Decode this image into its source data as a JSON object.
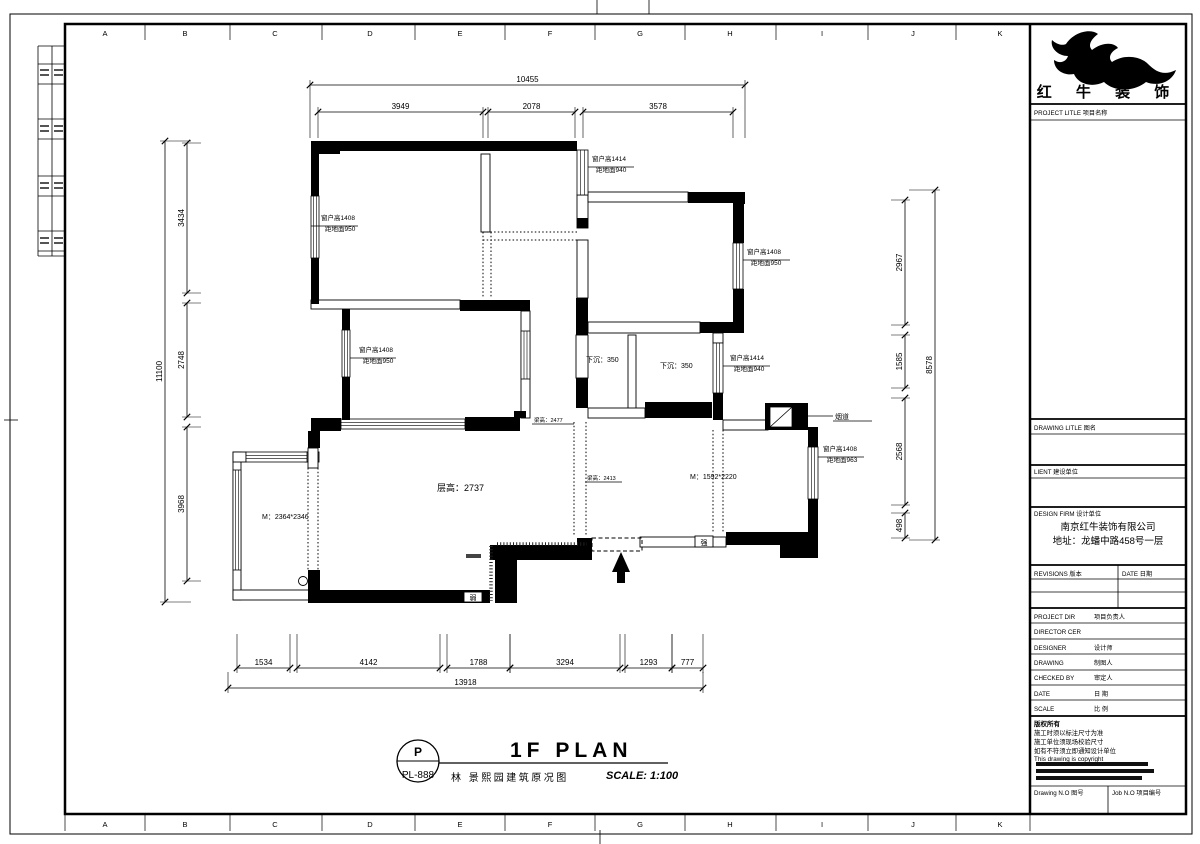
{
  "brand": {
    "company": "红 牛 装 饰",
    "project_label": "PROJECT LITLE  项目名称",
    "drawing_label": "DRAWING LITLE  图名",
    "client_label": "LIENT  建设单位",
    "design_firm_label": "DESIGN FIRM  设计单位",
    "firm_name": "南京红牛装饰有限公司",
    "firm_address": "地址：龙蟠中路458号一层",
    "revisions_label": "REVISIONS  版本",
    "date_col_label": "DATE  日期",
    "rows": [
      [
        "PROJECT DIR",
        "项目负责人"
      ],
      [
        "DIRECTOR CER",
        ""
      ],
      [
        "DESIGNER",
        "设计师"
      ],
      [
        "DRAWING",
        "制图人"
      ],
      [
        "CHECKED BY",
        "审定人"
      ],
      [
        "DATE",
        "日 期"
      ],
      [
        "SCALE",
        "比 例"
      ]
    ],
    "copyright_lines": [
      "版权所有",
      "施工时须以标注尺寸为准",
      "施工单位须现场校验尺寸",
      "如有不符须立即通知设计单位",
      "This drawing is copyright"
    ],
    "drawing_no_label": "Drawing N.O  图号",
    "job_no_label": "Job N.O  项目编号"
  },
  "title": {
    "code_top": "P",
    "code_bottom": "PL-888",
    "main": "1F PLAN",
    "sub": "林 景熙园建筑原况图",
    "scale": "SCALE: 1:100"
  },
  "grid_letters": [
    "A",
    "B",
    "C",
    "D",
    "E",
    "F",
    "G",
    "H",
    "I",
    "J",
    "K"
  ],
  "dims": [
    {
      "o": "h",
      "p": 85,
      "a": 310,
      "b": 745,
      "t": "10455",
      "e": 53
    },
    {
      "o": "h",
      "p": 112,
      "a": 318,
      "b": 483,
      "t": "3949",
      "e": 26
    },
    {
      "o": "h",
      "p": 112,
      "a": 488,
      "b": 575,
      "t": "2078",
      "e": 26
    },
    {
      "o": "h",
      "p": 112,
      "a": 583,
      "b": 733,
      "t": "3578",
      "e": 26
    },
    {
      "o": "v",
      "p": 165,
      "a": 141,
      "b": 602,
      "t": "11100",
      "e": 26
    },
    {
      "o": "v",
      "p": 187,
      "a": 143,
      "b": 293,
      "t": "3434",
      "e": 14
    },
    {
      "o": "v",
      "p": 187,
      "a": 303,
      "b": 417,
      "t": "2748",
      "e": 14
    },
    {
      "o": "v",
      "p": 187,
      "a": 427,
      "b": 581,
      "t": "3968",
      "e": 14
    },
    {
      "o": "v",
      "p": 935,
      "a": 190,
      "b": 540,
      "t": "8578",
      "e": -26
    },
    {
      "o": "v",
      "p": 905,
      "a": 200,
      "b": 325,
      "t": "2967",
      "e": -14
    },
    {
      "o": "v",
      "p": 905,
      "a": 335,
      "b": 388,
      "t": "1585",
      "e": -14
    },
    {
      "o": "v",
      "p": 905,
      "a": 398,
      "b": 505,
      "t": "2568",
      "e": -14
    },
    {
      "o": "v",
      "p": 905,
      "a": 513,
      "b": 538,
      "t": "498",
      "e": -14
    },
    {
      "o": "h",
      "p": 668,
      "a": 237,
      "b": 290,
      "t": "1534",
      "e": -34
    },
    {
      "o": "h",
      "p": 668,
      "a": 297,
      "b": 440,
      "t": "4142",
      "e": -34
    },
    {
      "o": "h",
      "p": 668,
      "a": 447,
      "b": 510,
      "t": "1788",
      "e": -34
    },
    {
      "o": "h",
      "p": 668,
      "a": 510,
      "b": 620,
      "t": "3294",
      "e": -34
    },
    {
      "o": "h",
      "p": 668,
      "a": 625,
      "b": 672,
      "t": "1293",
      "e": -34
    },
    {
      "o": "h",
      "p": 668,
      "a": 672,
      "b": 703,
      "t": "777",
      "e": -34
    },
    {
      "o": "h",
      "p": 688,
      "a": 228,
      "b": 703,
      "t": "13918",
      "e": -16
    }
  ],
  "annotations": [
    {
      "l1": "窗户高1408",
      "l2": "距地面950",
      "x": 321,
      "y": 220,
      "u": [
        311,
        226,
        358,
        226
      ]
    },
    {
      "l1": "窗户高1408",
      "l2": "距地面950",
      "x": 359,
      "y": 352,
      "u": [
        350,
        358,
        396,
        358
      ]
    },
    {
      "l1": "窗户高1414",
      "l2": "距地面940",
      "x": 592,
      "y": 161,
      "u": [
        588,
        167,
        634,
        167
      ]
    },
    {
      "l1": "窗户高1408",
      "l2": "距地面950",
      "x": 747,
      "y": 254,
      "u": [
        743,
        260,
        790,
        260
      ]
    },
    {
      "l1": "窗户高1414",
      "l2": "距地面940",
      "x": 730,
      "y": 360,
      "u": [
        723,
        366,
        770,
        366
      ]
    },
    {
      "l1": "窗户高1408",
      "l2": "距地面963",
      "x": 823,
      "y": 451,
      "u": [
        818,
        457,
        864,
        457
      ]
    }
  ],
  "labels": [
    {
      "t": "层高：2737",
      "x": 437,
      "y": 491,
      "fs": 9
    },
    {
      "t": "M：2364*2346",
      "x": 262,
      "y": 519,
      "fs": 7
    },
    {
      "t": "M：1592*2220",
      "x": 690,
      "y": 479,
      "fs": 7
    },
    {
      "t": "下沉：350",
      "x": 586,
      "y": 362,
      "fs": 7
    },
    {
      "t": "下沉：350",
      "x": 660,
      "y": 368,
      "fs": 7
    },
    {
      "t": "梁高：2477",
      "x": 534,
      "y": 422,
      "fs": 5.5,
      "ul": [
        532,
        424,
        574,
        424
      ]
    },
    {
      "t": "梁高：2413",
      "x": 587,
      "y": 480,
      "fs": 5.5,
      "ul": [
        585,
        482,
        622,
        482
      ]
    },
    {
      "t": "烟道",
      "x": 835,
      "y": 419,
      "fs": 7,
      "ul": [
        806,
        416,
        833,
        416
      ],
      "ul2": [
        833,
        421,
        872,
        421
      ]
    }
  ],
  "boxes": [
    {
      "t": "弱",
      "x": 464,
      "y": 592,
      "w": 18,
      "h": 10
    },
    {
      "t": "强",
      "x": 695,
      "y": 536,
      "w": 18,
      "h": 11
    }
  ],
  "plan": {
    "black_rects": [
      [
        311,
        141,
        29,
        13
      ],
      [
        340,
        141,
        237,
        10
      ],
      [
        688,
        192,
        55,
        11
      ],
      [
        733,
        192,
        12,
        12
      ],
      [
        311,
        154,
        8,
        42
      ],
      [
        311,
        258,
        8,
        46
      ],
      [
        342,
        309,
        8,
        21
      ],
      [
        342,
        377,
        8,
        43
      ],
      [
        460,
        300,
        70,
        11
      ],
      [
        465,
        417,
        55,
        14
      ],
      [
        514,
        411,
        12,
        7
      ],
      [
        311,
        418,
        30,
        13
      ],
      [
        577,
        218,
        11,
        10
      ],
      [
        733,
        203,
        11,
        40
      ],
      [
        733,
        289,
        11,
        44
      ],
      [
        700,
        322,
        43,
        11
      ],
      [
        576,
        298,
        12,
        37
      ],
      [
        576,
        378,
        12,
        30
      ],
      [
        645,
        402,
        67,
        16
      ],
      [
        713,
        393,
        10,
        27
      ],
      [
        765,
        403,
        43,
        27
      ],
      [
        808,
        427,
        10,
        20
      ],
      [
        808,
        499,
        10,
        46
      ],
      [
        726,
        532,
        92,
        13
      ],
      [
        780,
        532,
        38,
        26
      ],
      [
        308,
        431,
        12,
        17
      ],
      [
        308,
        570,
        12,
        33
      ],
      [
        318,
        590,
        172,
        13
      ],
      [
        490,
        545,
        97,
        15
      ],
      [
        495,
        560,
        22,
        43
      ],
      [
        577,
        538,
        15,
        22
      ]
    ],
    "thin_rects": [
      [
        481,
        154,
        9,
        78
      ],
      [
        577,
        195,
        11,
        33
      ],
      [
        588,
        192,
        100,
        10
      ],
      [
        588,
        322,
        112,
        11
      ],
      [
        577,
        240,
        11,
        58
      ],
      [
        576,
        335,
        12,
        43
      ],
      [
        628,
        335,
        8,
        75
      ],
      [
        713,
        333,
        10,
        10
      ],
      [
        311,
        300,
        149,
        9
      ],
      [
        521,
        311,
        9,
        107
      ],
      [
        233,
        452,
        8,
        148
      ],
      [
        233,
        590,
        78,
        10
      ],
      [
        233,
        452,
        13,
        10
      ],
      [
        305,
        452,
        14,
        10
      ],
      [
        723,
        420,
        45,
        10
      ],
      [
        308,
        448,
        10,
        20
      ],
      [
        588,
        408,
        57,
        10
      ],
      [
        640,
        537,
        86,
        10
      ]
    ],
    "windows": [
      [
        311,
        196,
        8,
        62
      ],
      [
        342,
        330,
        8,
        47
      ],
      [
        577,
        150,
        11,
        45
      ],
      [
        733,
        243,
        10,
        46
      ],
      [
        713,
        343,
        10,
        50
      ],
      [
        808,
        447,
        10,
        52
      ],
      [
        246,
        452,
        61,
        10
      ],
      [
        233,
        470,
        8,
        100
      ],
      [
        341,
        419,
        124,
        10
      ],
      [
        521,
        331,
        9,
        48
      ]
    ],
    "dotted": [
      [
        483,
        232,
        483,
        298
      ],
      [
        491,
        232,
        491,
        298
      ],
      [
        483,
        232,
        577,
        232
      ],
      [
        483,
        240,
        577,
        240
      ],
      [
        574,
        422,
        574,
        536
      ],
      [
        586,
        422,
        586,
        536
      ],
      [
        713,
        430,
        713,
        532
      ],
      [
        723,
        430,
        723,
        532
      ],
      [
        308,
        468,
        308,
        570
      ],
      [
        318,
        468,
        318,
        570
      ]
    ],
    "dashed_rects": [
      [
        592,
        538,
        50,
        13
      ]
    ],
    "stipple": [
      [
        491,
        546,
        491,
        601
      ],
      [
        497,
        544,
        587,
        544
      ]
    ],
    "circle": [
      303,
      581,
      4.5
    ],
    "flue_box": [
      770,
      407,
      22,
      20
    ],
    "arrow": {
      "tipx": 621,
      "tipy": 552,
      "basey": 572,
      "half": 9,
      "stemw": 8,
      "stemh": 11
    },
    "smudges": [
      [
        1036,
        762,
        112,
        4,
        "#111"
      ],
      [
        1036,
        769,
        118,
        4,
        "#111"
      ],
      [
        1036,
        776,
        106,
        4,
        "#111"
      ],
      [
        466,
        554,
        15,
        4,
        "#444"
      ]
    ],
    "margin_cells": [
      [
        40,
        69
      ],
      [
        54,
        69
      ],
      [
        40,
        125
      ],
      [
        54,
        125
      ],
      [
        40,
        182
      ],
      [
        54,
        182
      ],
      [
        40,
        237
      ],
      [
        54,
        237
      ]
    ],
    "lines": [
      [
        38,
        46,
        38,
        256
      ],
      [
        52,
        46,
        52,
        256
      ],
      [
        38,
        46,
        65,
        46
      ],
      [
        38,
        64,
        65,
        64
      ],
      [
        38,
        84,
        65,
        84
      ],
      [
        38,
        119,
        65,
        119
      ],
      [
        38,
        139,
        65,
        139
      ],
      [
        38,
        176,
        65,
        176
      ],
      [
        38,
        196,
        65,
        196
      ],
      [
        38,
        231,
        65,
        231
      ],
      [
        38,
        251,
        65,
        251
      ],
      [
        38,
        256,
        65,
        256
      ],
      [
        597,
        0,
        597,
        14
      ],
      [
        649,
        0,
        649,
        14
      ],
      [
        600,
        830,
        600,
        844
      ],
      [
        4,
        420,
        18,
        420
      ]
    ]
  }
}
